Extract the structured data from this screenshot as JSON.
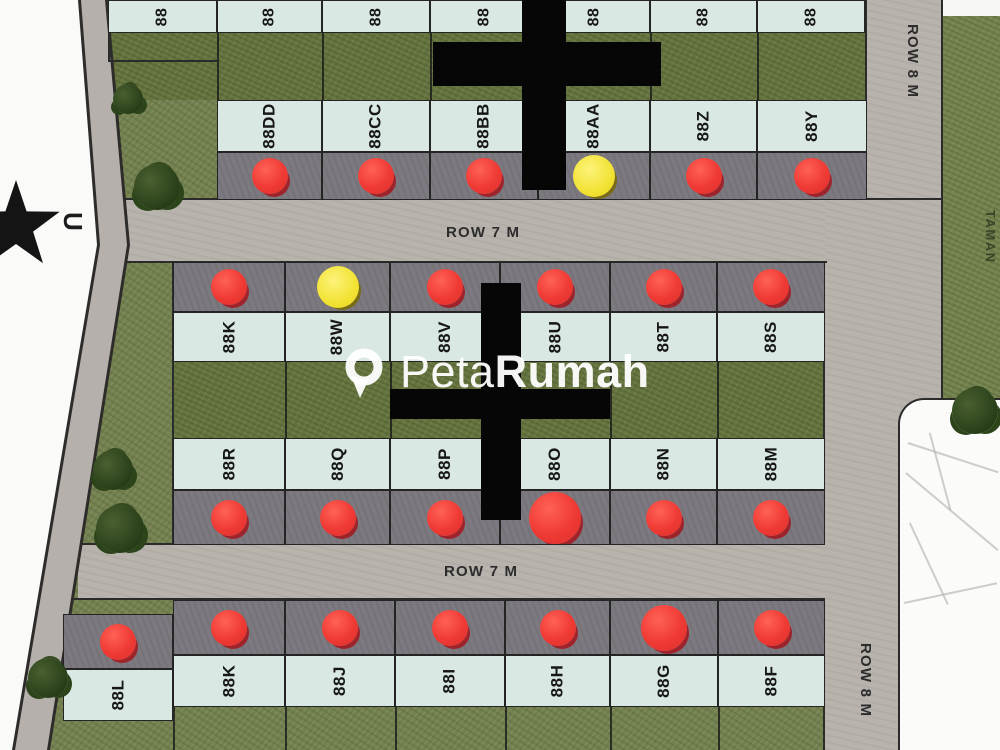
{
  "watermark": {
    "icon": "map-pin-icon",
    "light": "Peta",
    "bold": "Rumah"
  },
  "compass": {
    "north_label": "U"
  },
  "labels": {
    "row7m_top": "ROW 7 M",
    "row7m_bottom": "ROW 7 M",
    "row8m_top": "ROW 8 M",
    "row8m_bottom": "ROW 8 M",
    "park": "TAMAN"
  },
  "blocks": {
    "top_partial": {
      "plots": [
        {
          "label": "88"
        },
        {
          "label": "88"
        },
        {
          "label": "88"
        },
        {
          "label": "88"
        },
        {
          "label": "88"
        },
        {
          "label": "88"
        },
        {
          "label": "88"
        }
      ]
    },
    "a": {
      "plots": [
        {
          "label": "88DD",
          "status": "red"
        },
        {
          "label": "88CC",
          "status": "red"
        },
        {
          "label": "88BB",
          "status": "red"
        },
        {
          "label": "88AA",
          "status": "yellow"
        },
        {
          "label": "88Z",
          "status": "red"
        },
        {
          "label": "88Y",
          "status": "red"
        }
      ]
    },
    "b_upper": {
      "plots": [
        {
          "label": "88K",
          "status": "red"
        },
        {
          "label": "88W",
          "status": "yellow"
        },
        {
          "label": "88V",
          "status": "red"
        },
        {
          "label": "88U",
          "status": "red"
        },
        {
          "label": "88T",
          "status": "red"
        },
        {
          "label": "88S",
          "status": "red"
        }
      ]
    },
    "b_lower": {
      "plots": [
        {
          "label": "88R",
          "status": "red"
        },
        {
          "label": "88Q",
          "status": "red"
        },
        {
          "label": "88P",
          "status": "red"
        },
        {
          "label": "88O",
          "status": "red"
        },
        {
          "label": "88N",
          "status": "red"
        },
        {
          "label": "88M",
          "status": "red"
        }
      ]
    },
    "c": {
      "plots": [
        {
          "label": "88L",
          "status": "red"
        },
        {
          "label": "88K",
          "status": "red"
        },
        {
          "label": "88J",
          "status": "red"
        },
        {
          "label": "88I",
          "status": "red"
        },
        {
          "label": "88H",
          "status": "red"
        },
        {
          "label": "88G",
          "status": "red"
        },
        {
          "label": "88F",
          "status": "red"
        }
      ]
    }
  },
  "colors": {
    "grass": "#73804f",
    "grass_dark": "#66743f",
    "road": "#b9b3ae",
    "plot_cell": "#d9e8e2",
    "carport": "#7c7980",
    "outline": "#242424",
    "red_dot": "#ef3a34",
    "yellow_dot": "#f2e234",
    "cross": "#060606"
  }
}
